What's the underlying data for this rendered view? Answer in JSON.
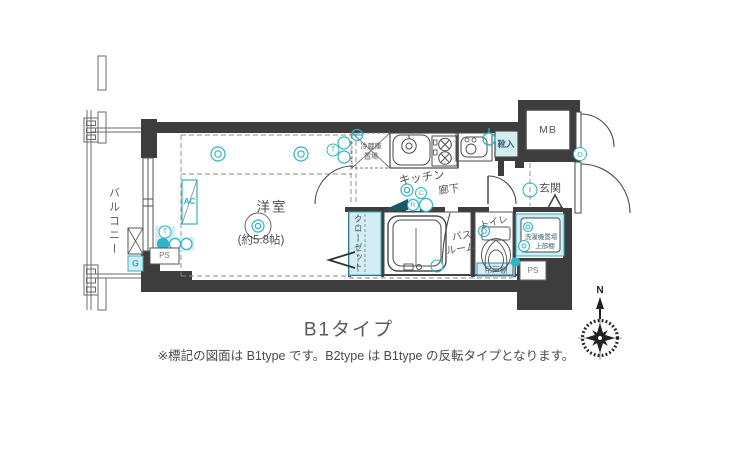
{
  "floorplan": {
    "title": "B1タイプ",
    "note": "※標記の図面は B1type です。B2type は B1type の反転タイプとなります。",
    "compass": {
      "north": "N"
    },
    "labels": {
      "balcony": "バルコニー",
      "room": "洋室",
      "room_size": "(約5.8帖)",
      "kitchen": "キッチン",
      "hallway": "廊下",
      "entrance": "玄関",
      "toilet": "トイレ",
      "bath_line1": "バス",
      "bath_line2": "ルーム",
      "closet": "クローゼット",
      "fridge_line1": "冷蔵庫",
      "fridge_line2": "置場",
      "shoe_cabinet": "靴入",
      "washer_line1": "洗濯機置場",
      "washer_line2": "上部棚",
      "hanging_shelf": "吊戸棚",
      "meter_box": "MB",
      "pipe_shaft_left": "PS",
      "pipe_shaft_right": "PS",
      "air_conditioner": "AC",
      "gas_meter": "G"
    },
    "symbols": {
      "t_outlet": "T",
      "c_outlet": "C",
      "r_outlet": "R",
      "d_outlet": "D"
    },
    "colors": {
      "wall": "#3d3d3d",
      "line": "#4a4a4a",
      "accent": "#2fb3c7",
      "accent_light": "#d4edf4",
      "text": "#555555"
    }
  }
}
